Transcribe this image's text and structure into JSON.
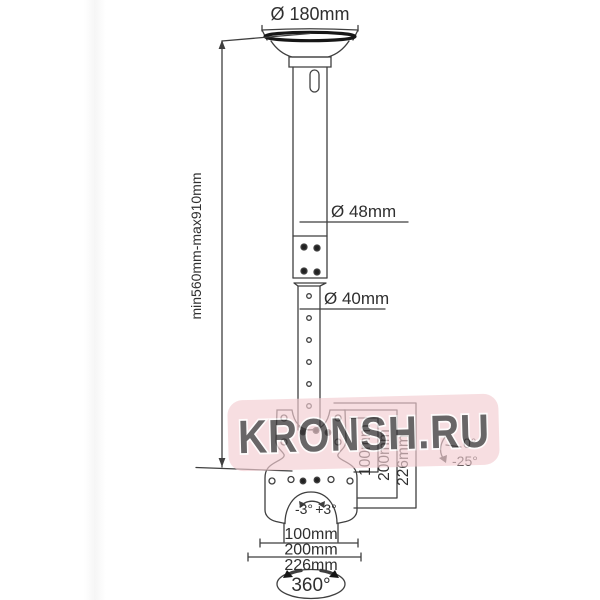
{
  "diagram": {
    "title_hint": "ceiling tv mount technical drawing",
    "top_diameter": "Ø 180mm",
    "height_range": "min560mm-max910mm",
    "upper_pole_diameter": "Ø 48mm",
    "lower_pole_diameter": "Ø 40mm",
    "plate_heights": {
      "h1": "100mm",
      "h2": "200mm",
      "h3": "226mm"
    },
    "plate_widths": {
      "w1": "100mm",
      "w2": "200mm",
      "w3": "226mm"
    },
    "swivel_left": "-3°",
    "swivel_right": "+3°",
    "tilt_up": "0°",
    "tilt_down": "-25°",
    "rotation": "360°"
  },
  "watermark": {
    "text": "KRONSH.RU"
  },
  "colors": {
    "line": "#3f3f3f",
    "dark": "#1c1c1c",
    "watermark_bg": "#f3cdd2",
    "watermark_text": "#e49ca7"
  }
}
